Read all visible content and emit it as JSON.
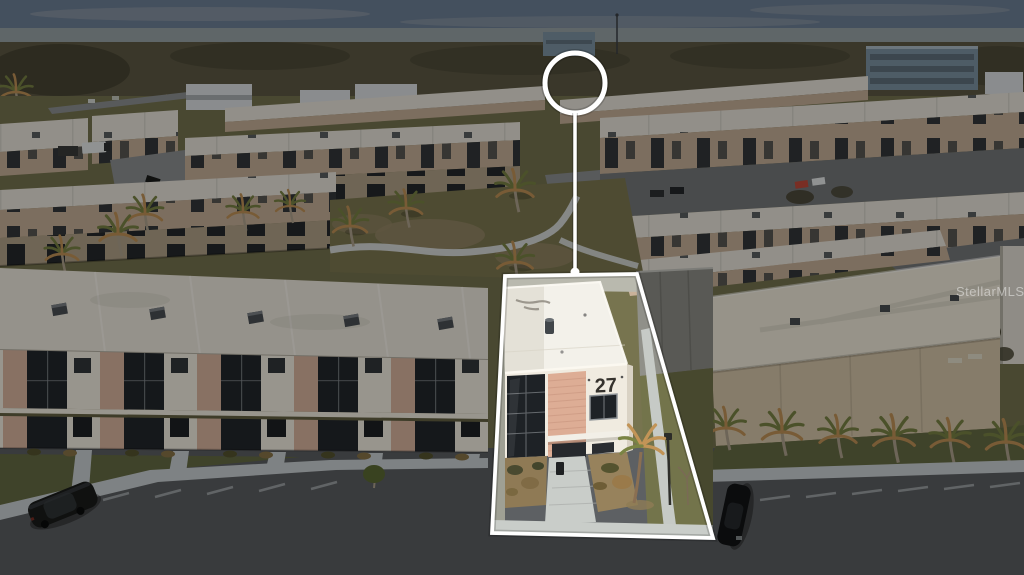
{
  "photo": {
    "description": "Aerial drone photograph of a townhome community at dusk; one three-story unit is spotlighted with a white outline, a circle marker above it connected by a pointer line.",
    "unit_number": "27",
    "watermark": "StellarMLS"
  },
  "markers": {
    "highlight_shape": "polygon",
    "circle_marker": "location-circle",
    "pointer": "vertical-line-with-dot",
    "outline_color": "#ffffff"
  },
  "colors": {
    "sky-top": "#6f8198",
    "sky-low": "#9aa5a9",
    "cloud": "#b5b8bb",
    "tree": "#5e5a44",
    "tree-dark": "#494635",
    "ground": "#77744f",
    "far-bldg": "#dfe3e5",
    "far-win": "#8a8f92",
    "office": "#7f95a5",
    "office-dark": "#5c6b78",
    "mid-roof": "#ece7dd",
    "mid-wall": "#c9b29a",
    "mid-win": "#34383b",
    "road": "#77797b",
    "drive": "#8e9193",
    "court-grass": "#7f7a51",
    "court-dirt": "#998a69",
    "path": "#e2e7e9",
    "fg-roof": "#f1ece0",
    "fg-pink": "#dcb6a0",
    "fg-glass": "#23272c",
    "fg-white": "#f6f0e4",
    "lawn": "#676c44",
    "sidewalk": "#ccd2d5",
    "asphalt": "#5d6063",
    "stripe": "#aeb3b5",
    "car-dark": "#1a1c1b",
    "car-dark2": "#121416",
    "red-car": "#c44b3a",
    "white-car": "#e8ecec",
    "rb-roof": "#f4eedd",
    "rb-wall": "#d8c8ab",
    "palm-green": "#7a8444",
    "palm-orange": "#c29457",
    "trunk": "#b0a48e",
    "hl-roof": "#f3f1ea",
    "hl-roof-shade": "#e4e1d7",
    "hl-wall": "#f0ebe0",
    "hl-brick": "#ddad95",
    "hl-brick-line": "#c99780",
    "hl-glass": "#1e2226",
    "hl-frame": "#777c80",
    "hl-walk": "#c9cdc9",
    "hl-grass": "#73744b",
    "hl-dirt": "#9d8a66",
    "hl-shrub": "#806b45",
    "hl-wall-gray": "#909089",
    "number": "#35322d"
  },
  "overlay": {
    "dim_opacity": 0.38
  }
}
